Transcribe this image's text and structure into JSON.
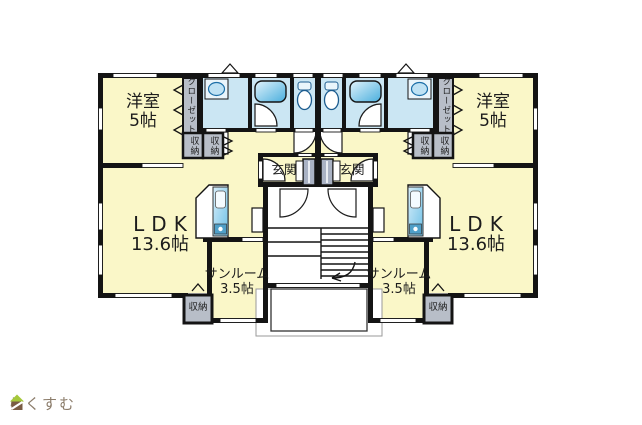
{
  "floorplan": {
    "rooms": {
      "bedroom": {
        "label": "洋室",
        "size": "5帖"
      },
      "ldk": {
        "label": "LDK",
        "size": "13.6帖"
      },
      "sunroom": {
        "label": "サンルーム",
        "size": "3.5帖"
      },
      "entrance": {
        "label": "玄関"
      },
      "closet": {
        "label": "クローゼット"
      },
      "storage": {
        "label": "収納"
      }
    },
    "units": [
      "left",
      "right"
    ],
    "colors": {
      "room_yellow": "#faf7c8",
      "wet_blue": "#cbe6f3",
      "storage_gray": "#b8bec8",
      "cabinet_gray": "#a9b2c4",
      "fixture_blue": "#5fb8de",
      "wall": "#141414"
    }
  },
  "logo": {
    "text": "らくすむ",
    "roof_color": "#a5c83b",
    "body_color": "#7a5c44",
    "text_color": "#8b7c6a"
  }
}
